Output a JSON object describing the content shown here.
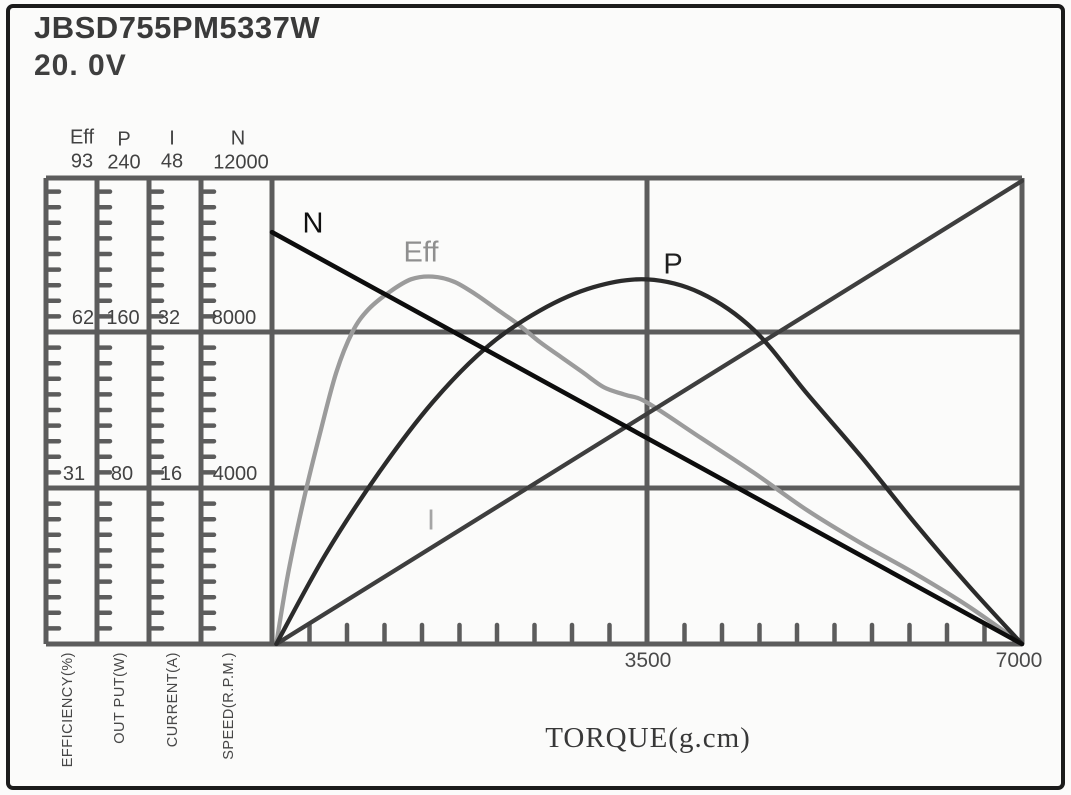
{
  "header": {
    "title": "JBSD755PM5337W",
    "voltage": "20. 0V"
  },
  "chart_data": {
    "type": "line",
    "title": "JBSD755PM5337W 20.0V motor performance curves",
    "x_axis": {
      "title": "TORQUE(g.cm)",
      "min": 0,
      "max": 7000,
      "labeled_ticks": [
        3500,
        7000
      ],
      "minor_tick_step": 350
    },
    "y_axes": [
      {
        "key": "Eff",
        "unit": "EFFICIENCY(%)",
        "max": 93,
        "tick_labels": [
          93,
          62,
          31
        ]
      },
      {
        "key": "P",
        "unit": "OUT PUT(W)",
        "max": 240,
        "tick_labels": [
          240,
          160,
          80
        ]
      },
      {
        "key": "I",
        "unit": "CURRENT(A)",
        "max": 48,
        "tick_labels": [
          48,
          32,
          16
        ]
      },
      {
        "key": "N",
        "unit": "SPEED(R.P.M.)",
        "max": 12000,
        "tick_labels": [
          12000,
          8000,
          4000
        ]
      }
    ],
    "series": [
      {
        "label": "N",
        "unit": "R.P.M.",
        "color": "#0d0d0d",
        "axis_max": 12000,
        "points": [
          [
            0,
            10560
          ],
          [
            7000,
            0
          ]
        ]
      },
      {
        "label": "Eff",
        "unit": "%",
        "color": "#9b9b9b",
        "axis_max": 93,
        "points": [
          [
            40,
            0
          ],
          [
            150,
            14
          ],
          [
            300,
            29
          ],
          [
            450,
            42
          ],
          [
            600,
            54
          ],
          [
            750,
            62
          ],
          [
            900,
            66.5
          ],
          [
            1100,
            70
          ],
          [
            1300,
            72.5
          ],
          [
            1500,
            73
          ],
          [
            1700,
            72
          ],
          [
            1900,
            69.5
          ],
          [
            2100,
            66.5
          ],
          [
            2300,
            63.5
          ],
          [
            2500,
            60
          ],
          [
            2700,
            57
          ],
          [
            2900,
            54
          ],
          [
            3100,
            51
          ],
          [
            3300,
            49.5
          ],
          [
            3500,
            48
          ],
          [
            4000,
            41
          ],
          [
            4500,
            34
          ],
          [
            5000,
            26.5
          ],
          [
            5500,
            20
          ],
          [
            6000,
            14
          ],
          [
            6500,
            7.5
          ],
          [
            7000,
            0
          ]
        ]
      },
      {
        "label": "P",
        "unit": "W",
        "color": "#2b2b2b",
        "axis_max": 240,
        "points": [
          [
            40,
            0
          ],
          [
            500,
            46
          ],
          [
            1000,
            88
          ],
          [
            1500,
            124
          ],
          [
            2000,
            152
          ],
          [
            2500,
            171
          ],
          [
            3000,
            183
          ],
          [
            3500,
            187
          ],
          [
            4000,
            180
          ],
          [
            4500,
            161
          ],
          [
            5000,
            128
          ],
          [
            5500,
            96
          ],
          [
            6000,
            62
          ],
          [
            6500,
            30
          ],
          [
            7000,
            0
          ]
        ]
      },
      {
        "label": "I",
        "unit": "A",
        "color": "#3e3e3e",
        "axis_max": 48,
        "points": [
          [
            40,
            0
          ],
          [
            7000,
            47.5
          ]
        ]
      }
    ]
  }
}
